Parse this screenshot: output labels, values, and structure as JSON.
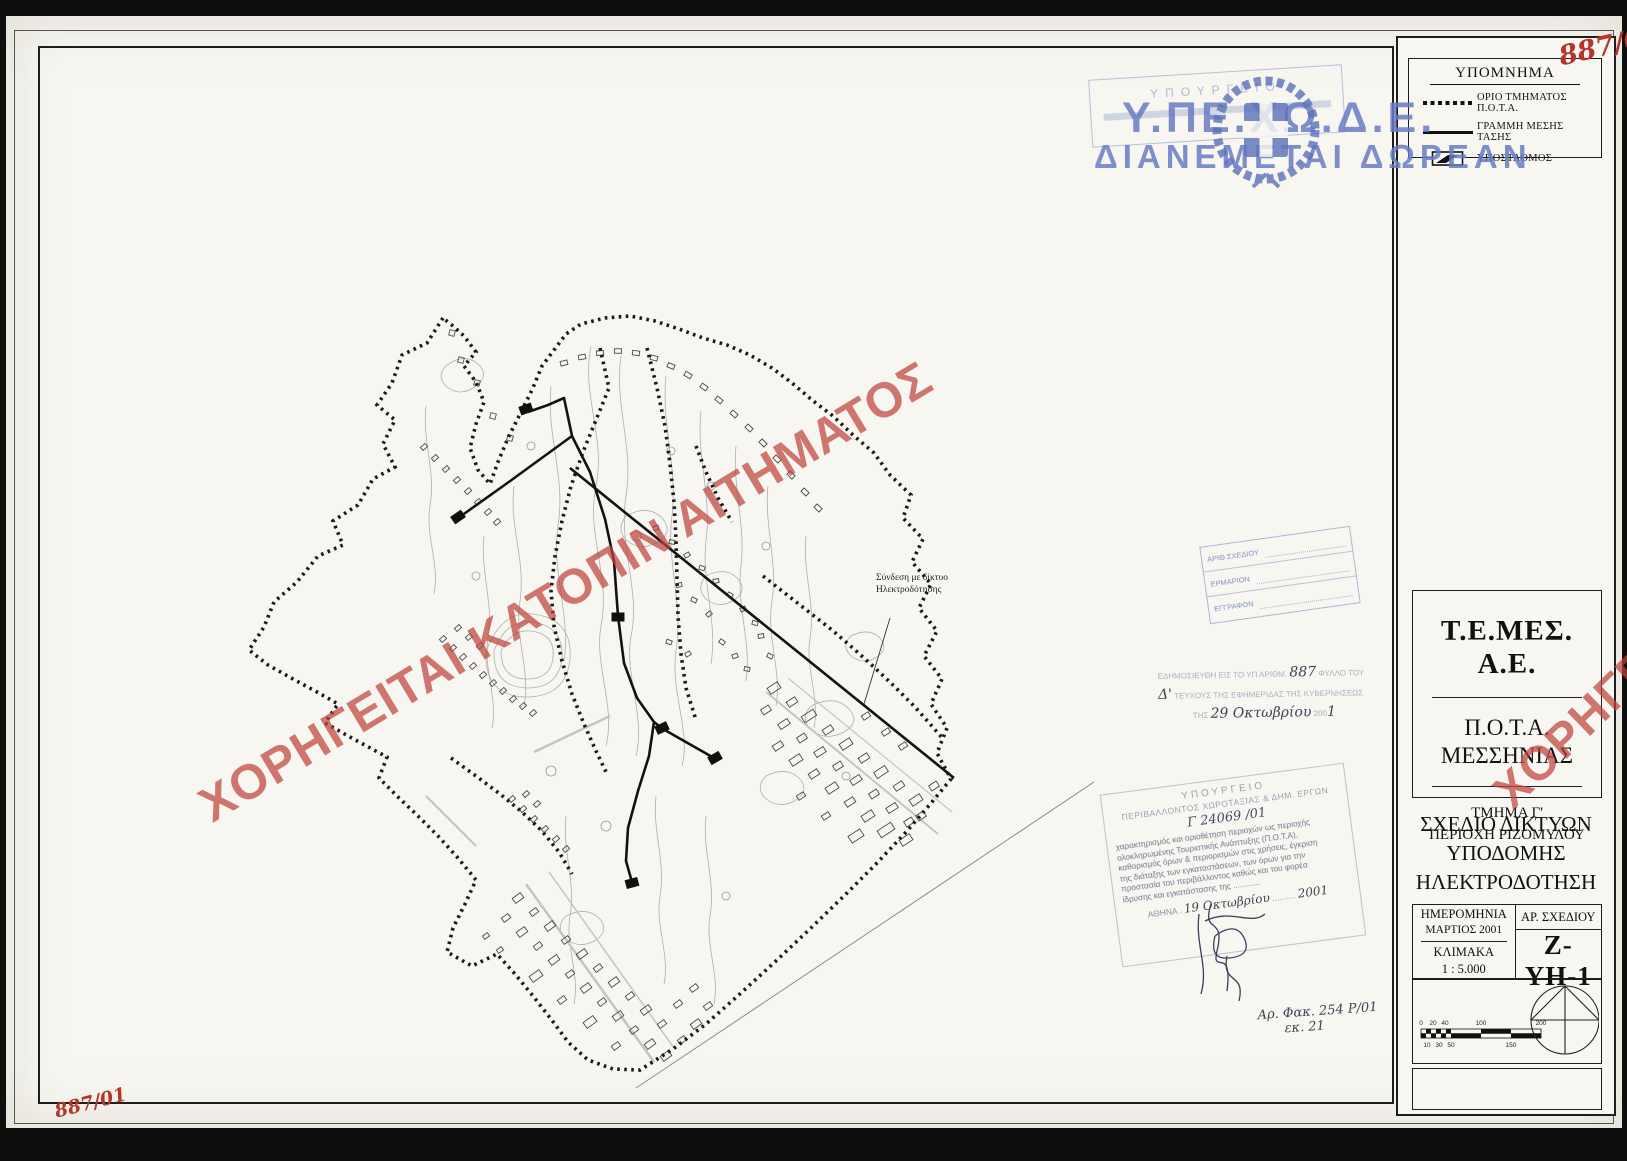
{
  "page": {
    "ref_top": "887/01",
    "ref_bottom": "887/01"
  },
  "watermark": {
    "text": "ΧΟΡΗΓΕΙΤΑΙ ΚΑΤΟΠΙΝ ΑΙΤΗΜΑΤΟΣ"
  },
  "distribution_stamp": {
    "line1": "Υ.ΠΕ.ΧΩ.Δ.Ε.",
    "line2": "ΔΙΑΝΕΜΕΤΑΙ ΔΩΡΕΑΝ"
  },
  "receipt_stamp": {
    "line1": "ΥΠΟΥΡΓΕΙΟ"
  },
  "legend": {
    "title": "ΥΠΟΜΝΗΜΑ",
    "items": [
      {
        "label": "ΟΡΙΟ ΤΜΗΜΑΤΟΣ Π.Ο.Τ.Α."
      },
      {
        "label": "ΓΡΑΜΜΗ ΜΕΣΗΣ ΤΑΣΗΣ"
      },
      {
        "label": "ΥΠΟΣΤΑΘΜΟΣ"
      }
    ]
  },
  "title_block": {
    "company": "Τ.Ε.ΜΕΣ. Α.Ε.",
    "project_line1": "Π.Ο.Τ.Α.",
    "project_line2": "ΜΕΣΣΗΝΙΑΣ",
    "section_line1": "ΤΜΗΜΑ Γ'",
    "section_line2": "ΠΕΡΙΟΧΗ ΡΙΖΟΜΥΛΟΥ",
    "drawing_title_line1": "ΣΧΕΔΙΟ ΔΙΚΤΥΩΝ",
    "drawing_title_line2": "ΥΠΟΔΟΜΗΣ",
    "drawing_title_line3": "ΗΛΕΚΤΡΟΔΟΤΗΣΗ",
    "date_label": "ΗΜΕΡΟΜΗΝΙΑ",
    "date_value": "ΜΑΡΤΙΟΣ 2001",
    "scale_label": "ΚΛΙΜΑΚΑ",
    "scale_value": "1 : 5.000",
    "number_label": "ΑΡ. ΣΧΕΔΙΟΥ",
    "number_value": "Ζ-ΥΗ-1"
  },
  "scale_bar": {
    "top_labels": [
      "0",
      "20",
      "40",
      "100",
      "200"
    ],
    "bottom_labels": [
      "10",
      "30",
      "50",
      "150"
    ]
  },
  "gazette_stamp": {
    "printed1": "ΕΔΗΜΟΣΙΕΥΘΗ ΕΙΣ ΤΟ ΥΠ ΑΡΙΘΜ.",
    "hw_number": "887",
    "printed1b": "ΦΥΛΛΟ ΤΟΥ",
    "hw_issue": "Δ'",
    "printed2": "ΤΕΥΧΟΥΣ ΤΗΣ ΕΦΗΜΕΡΙΔΑΣ ΤΗΣ ΚΥΒΕΡΝΗΣΕΩΣ",
    "printed3": "ΤΗΣ",
    "hw_date": "29 Οκτωβρίου",
    "printed3b": "200",
    "hw_year": "1"
  },
  "approval_stamp": {
    "header1": "ΥΠΟΥΡΓΕΙΟ",
    "header2": "ΠΕΡΙΒΑΛΛΟΝΤΟΣ ΧΩΡΟΤΑΞΙΑΣ & ΔΗΜ. ΕΡΓΩΝ",
    "protocol": "Γ 24069 /01",
    "body": [
      "χαρακτηρισμός και οριοθέτηση περιοχών ως περιοχής",
      "ολοκληρωμένης Τουριστικής Ανάπτυξης (Π.Ο.Τ.Α),",
      "καθορισμός όρων & περιορισμών στις χρήσεις, έγκριση",
      "της διάταξης των εγκαταστάσεων, των όρων για την",
      "προστασία του περιβάλλοντος καθώς και του φορέα",
      "ίδρυσης και εγκατάστασης της ............"
    ],
    "city": "ΑΘΗΝΑ",
    "hw_date": "19 Οκτωβρίου",
    "year": "2001"
  },
  "register_stamp": {
    "rows": [
      "ΑΡΙΘ ΣΧΕΔΙΟΥ",
      "ΕΡΜΑΡΙΟΝ",
      "ΕΓΓΡΑΦΟΝ"
    ]
  },
  "file_note": {
    "line1": "Αρ. Φακ. 254 Ρ/01",
    "line2": "εκ. 21"
  },
  "map": {
    "annotation_line1": "Σύνδεση με δίκτυο",
    "annotation_line2": "Ηλεκτροδότησης"
  }
}
